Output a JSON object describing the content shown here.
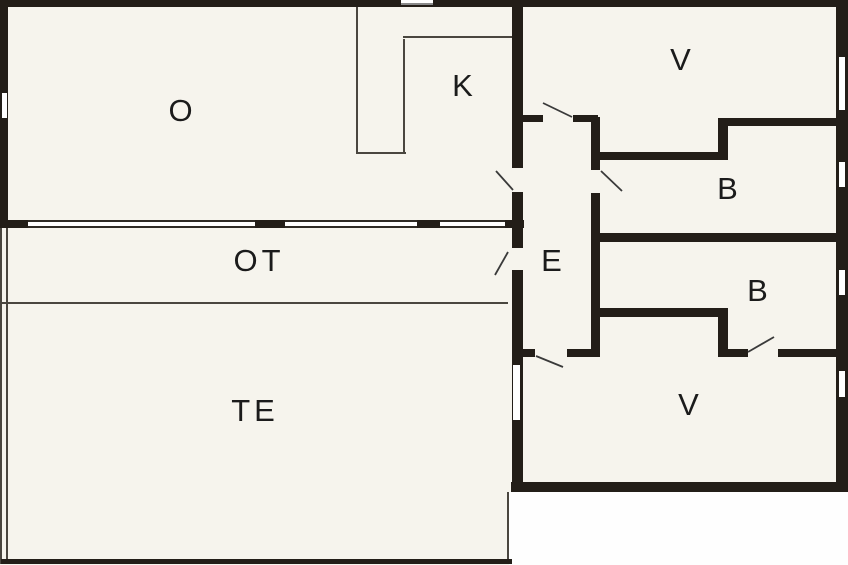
{
  "plan": {
    "type": "floor-plan",
    "rooms": [
      {
        "key": "o",
        "label": "O"
      },
      {
        "key": "k",
        "label": "K"
      },
      {
        "key": "v_upper",
        "label": "V"
      },
      {
        "key": "b_upper",
        "label": "B"
      },
      {
        "key": "e",
        "label": "E"
      },
      {
        "key": "b_lower",
        "label": "B"
      },
      {
        "key": "v_lower",
        "label": "V"
      },
      {
        "key": "ot",
        "label": "OT"
      },
      {
        "key": "te",
        "label": "TE"
      }
    ],
    "colors": {
      "wall": "#231e18",
      "room_fill": "#f6f4ed",
      "outside": "#fefefe",
      "thin_partition": "#4a463f",
      "door_swing": "#3a3a3a",
      "label_text": "#1b1b1b"
    }
  }
}
